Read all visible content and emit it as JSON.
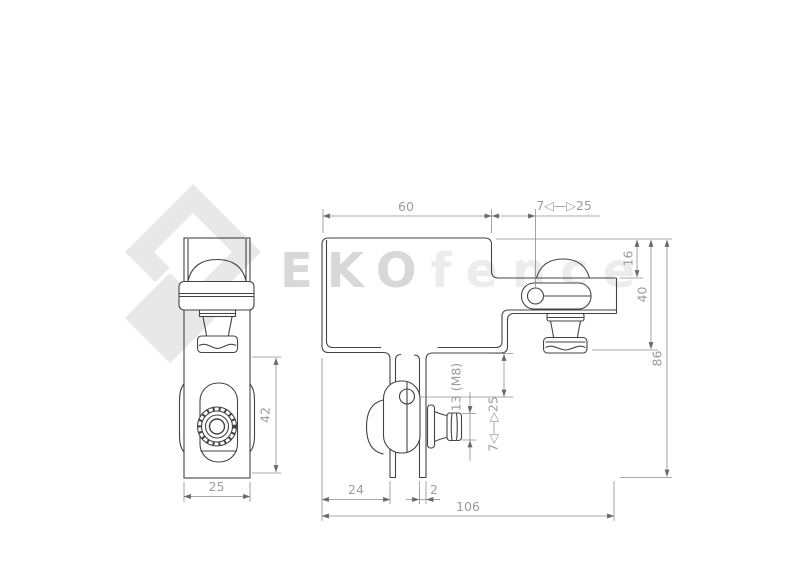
{
  "watermark": {
    "brand_bold": "EKO",
    "brand_light": "fence"
  },
  "dimensions": {
    "top_width": "60",
    "top_range": "7◁—▷25",
    "right_upper": "16",
    "right_mid": "40",
    "right_total": "86",
    "thread": "13 (M8)",
    "jaw_range": "7◁—▷25",
    "side_height": "42",
    "side_width": "25",
    "bottom_left": "24",
    "thickness": "2",
    "bottom_total": "106"
  },
  "colors": {
    "part_line": "#434343",
    "dim_line": "#8d8d8d",
    "dim_text": "#9c9c9c",
    "watermark_dark": "#d8d8d8",
    "watermark_light": "#ececec",
    "logo_gray": "#e8e8e8"
  }
}
